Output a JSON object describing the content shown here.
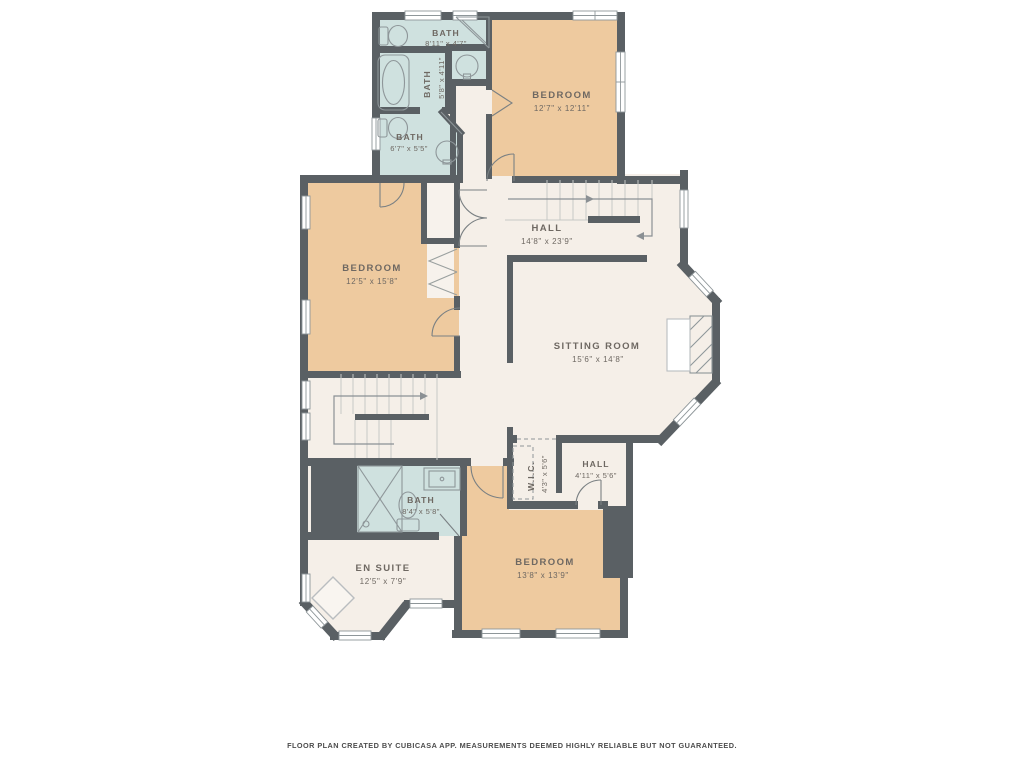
{
  "footer": "FLOOR PLAN CREATED BY CUBICASA APP. MEASUREMENTS DEEMED HIGHLY RELIABLE BUT NOT GUARANTEED.",
  "rooms": {
    "bath_top": {
      "name": "BATH",
      "dims": "8'11\" x 4'7\""
    },
    "bath_tub": {
      "name": "BATH",
      "dims": "5'8\" x 4'11\""
    },
    "bath_mid": {
      "name": "BATH",
      "dims": "6'7\" x 5'5\""
    },
    "bedroom_top": {
      "name": "BEDROOM",
      "dims": "12'7\" x 12'11\""
    },
    "bedroom_mid": {
      "name": "BEDROOM",
      "dims": "12'5\" x 15'8\""
    },
    "hall_main": {
      "name": "HALL",
      "dims": "14'8\" x 23'9\""
    },
    "sitting_room": {
      "name": "SITTING ROOM",
      "dims": "15'6\" x 14'8\""
    },
    "wic": {
      "name": "W.I.C.",
      "dims": "4'3\" x 5'6\""
    },
    "hall_lower": {
      "name": "HALL",
      "dims": "4'11\" x 5'6\""
    },
    "bedroom_bottom": {
      "name": "BEDROOM",
      "dims": "13'8\" x 13'9\""
    },
    "en_suite": {
      "name": "EN SUITE",
      "dims": "12'5\" x 7'9\""
    },
    "bath_ensuite": {
      "name": "BATH",
      "dims": "8'4\" x 5'8\""
    }
  },
  "icons": {
    "toilet-icon": "toilet fixture",
    "bathtub-icon": "bathtub fixture",
    "shower-icon": "corner shower",
    "sink-icon": "round basin",
    "vanity-icon": "vanity sink",
    "staircase-icon": "stairs with direction arrow",
    "fireplace-icon": "hatched fireplace",
    "closet-doors-icon": "bifold closet doors",
    "door-arc-icon": "door swing arc",
    "window-icon": "window"
  },
  "colors": {
    "wall": "#5a6064",
    "bedroom_floor": "#eeca9f",
    "bath_floor": "#cfe1df",
    "hall_floor": "#f5efe8",
    "background": "#ffffff",
    "label_text": "#6e6862",
    "fixture_line": "#8e9699",
    "stair_line": "#c6c9c6"
  }
}
